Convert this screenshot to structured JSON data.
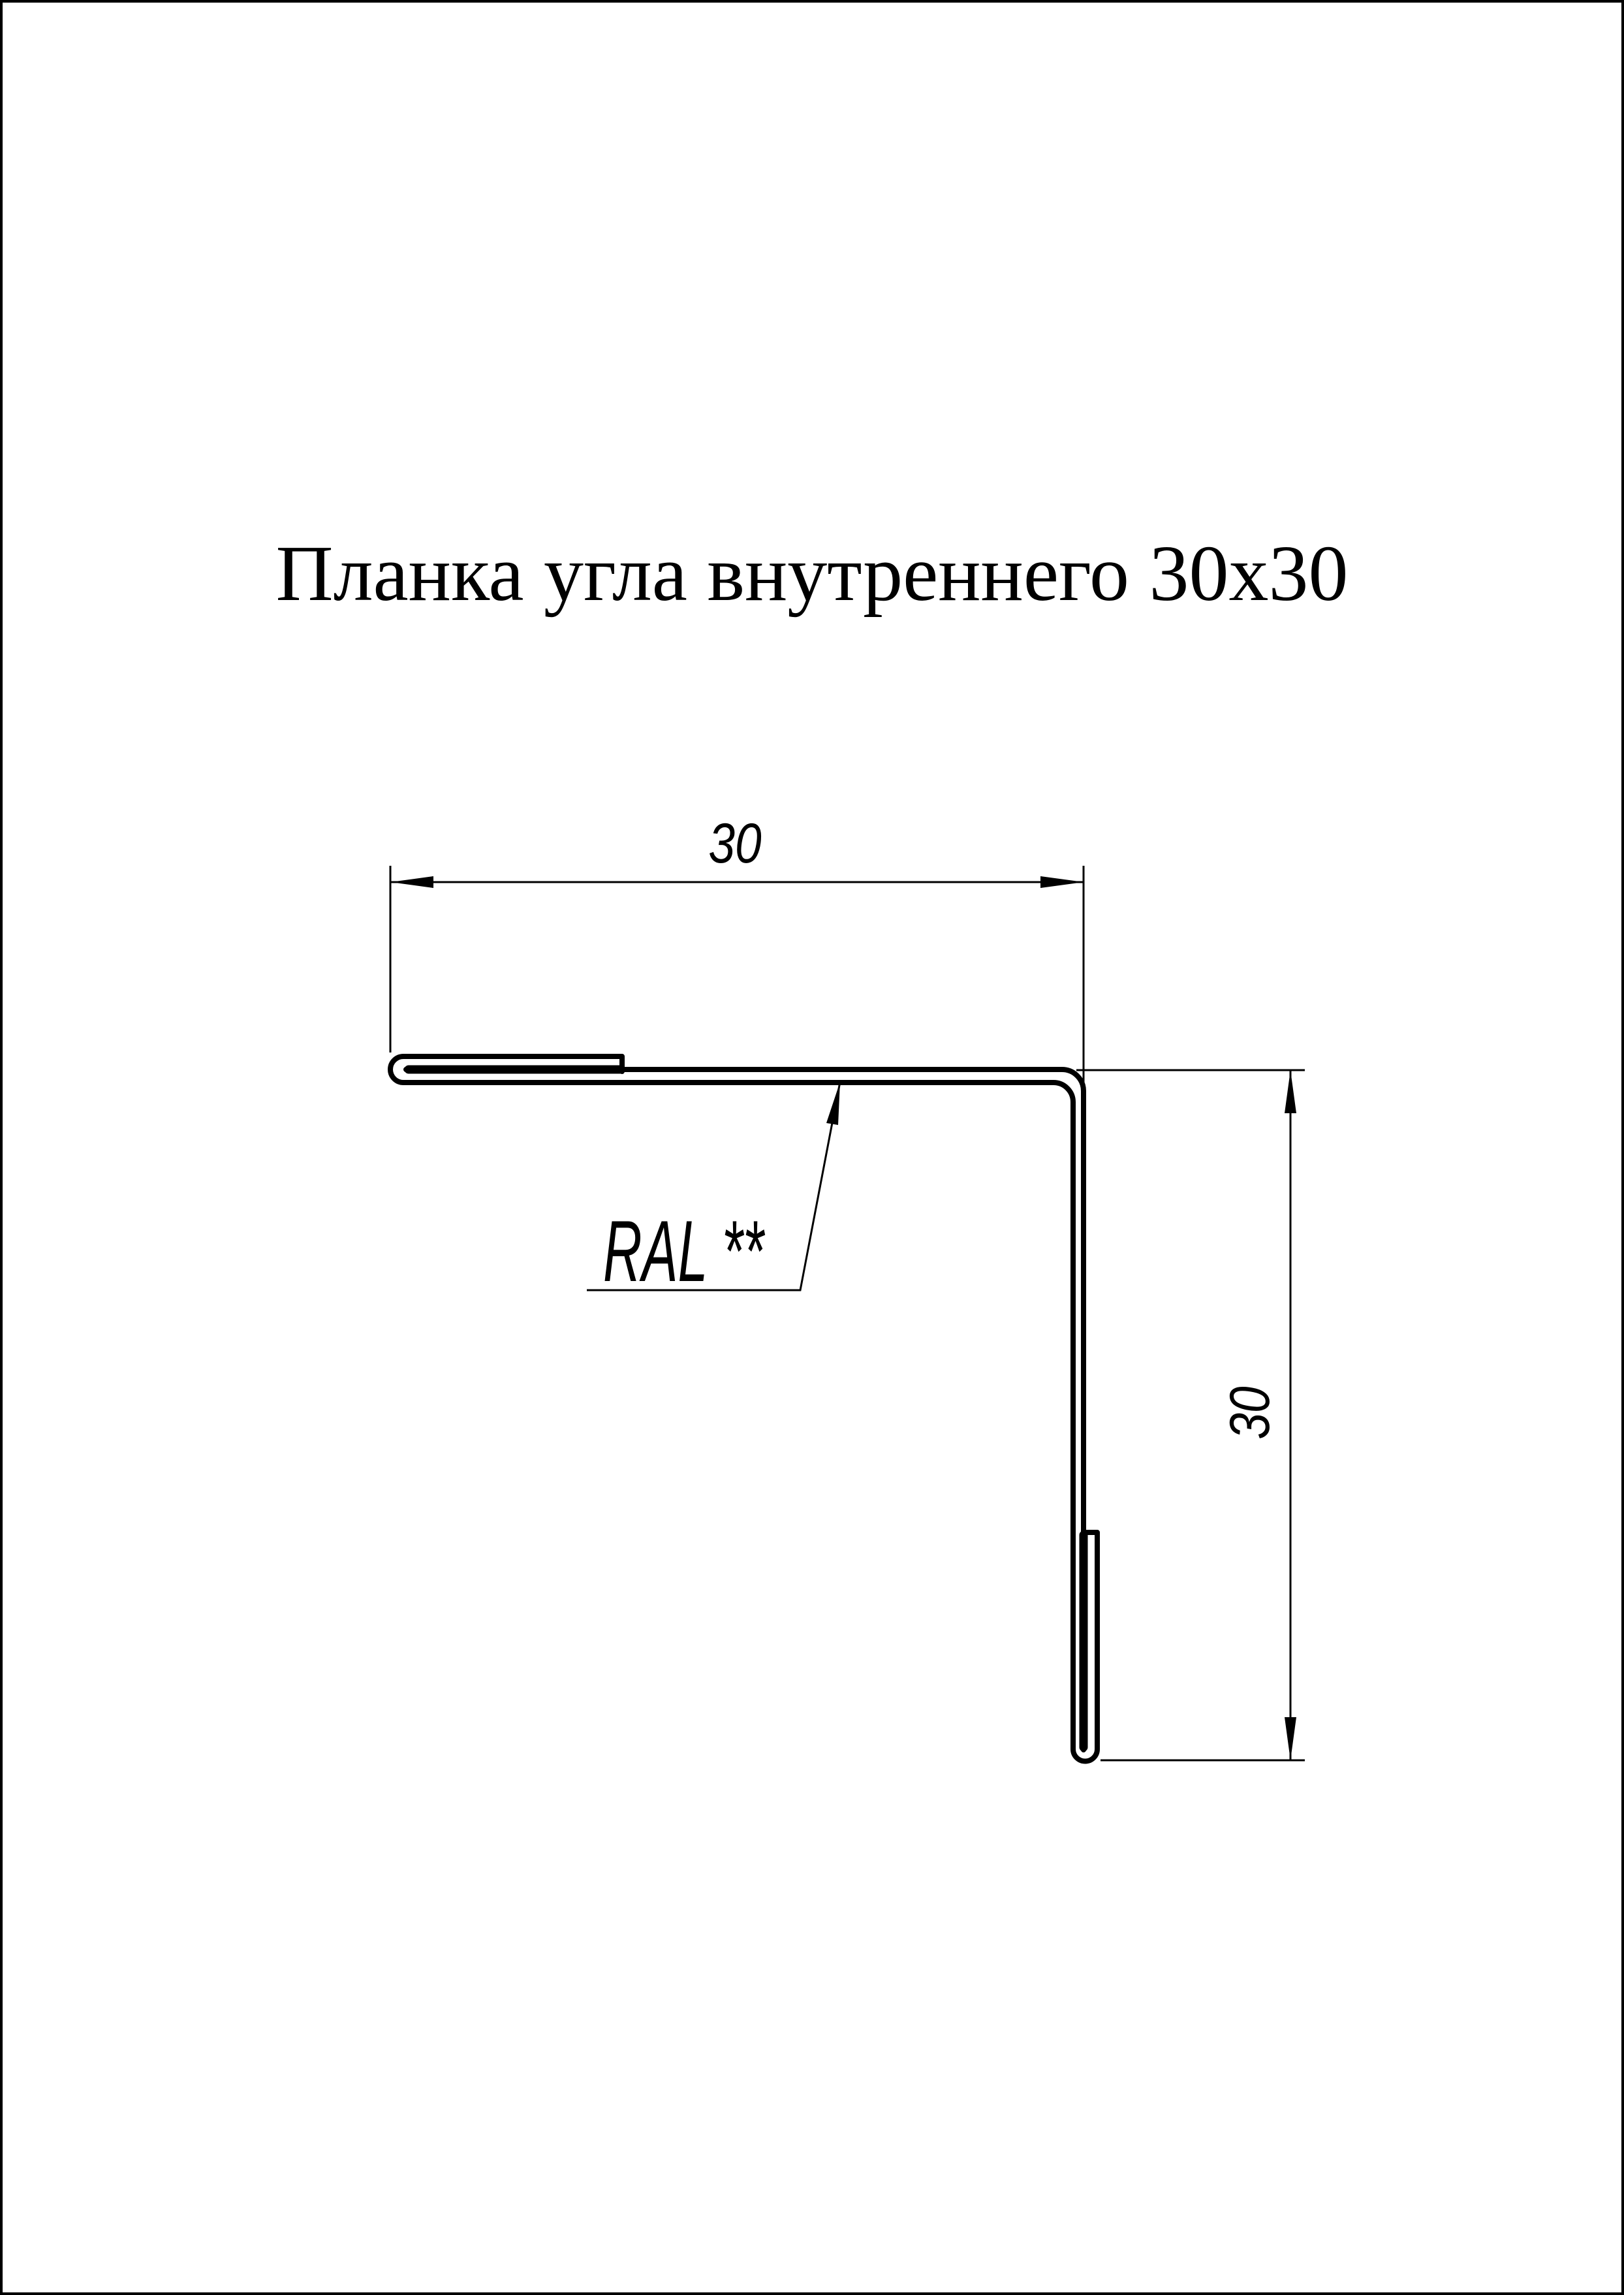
{
  "page": {
    "title": "Планка угла внутреннего 30x30",
    "background_color": "#ffffff",
    "border_color": "#000000"
  },
  "drawing": {
    "line_color": "#000000",
    "dim_top": {
      "value": "30"
    },
    "dim_side": {
      "value": "30"
    },
    "leader": {
      "label": "RAL **"
    }
  }
}
